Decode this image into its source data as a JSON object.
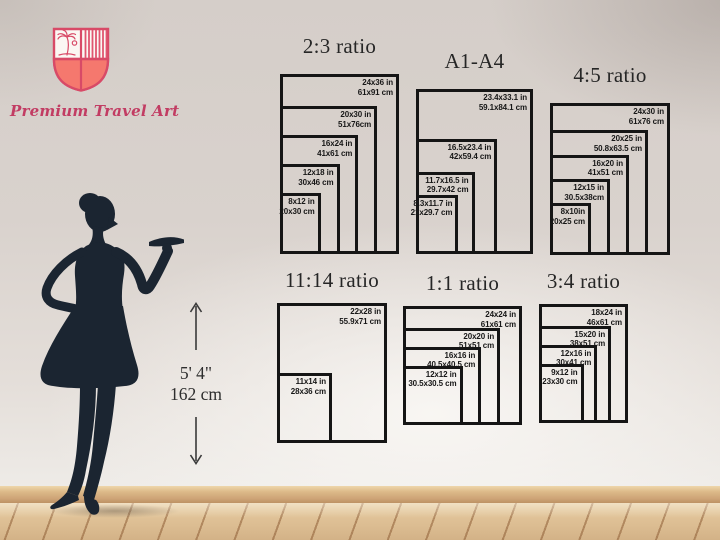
{
  "brand": {
    "name": "Premium Travel Art",
    "logo_icon": "shield-palm-crest-icon",
    "accent_color": "#d84a67",
    "shield_fill_color": "#f5786e",
    "name_color": "#c23c63"
  },
  "figure": {
    "kind": "woman-silhouette",
    "color": "#1b2531",
    "height_imperial": "5' 4\"",
    "height_metric": "162 cm"
  },
  "frame_line_color": "#151515",
  "charts": [
    {
      "title": "2:3 ratio",
      "sizes": [
        {
          "in": "24x36 in",
          "cm": "61x91 cm",
          "w": 24,
          "h": 36
        },
        {
          "in": "20x30 in",
          "cm": "51x76cm",
          "w": 20,
          "h": 30
        },
        {
          "in": "16x24 in",
          "cm": "41x61 cm",
          "w": 16,
          "h": 24
        },
        {
          "in": "12x18 in",
          "cm": "30x46 cm",
          "w": 12,
          "h": 18
        },
        {
          "in": "8x12 in",
          "cm": "20x30 cm",
          "w": 8,
          "h": 12
        }
      ]
    },
    {
      "title": "A1-A4",
      "sizes": [
        {
          "in": "23.4x33.1 in",
          "cm": "59.1x84.1 cm",
          "w": 23.4,
          "h": 33.1
        },
        {
          "in": "16.5x23.4 in",
          "cm": "42x59.4 cm",
          "w": 16.5,
          "h": 23.4
        },
        {
          "in": "11.7x16.5 in",
          "cm": "29.7x42 cm",
          "w": 11.7,
          "h": 16.5
        },
        {
          "in": "8.3x11.7 in",
          "cm": "21x29.7 cm",
          "w": 8.3,
          "h": 11.7
        }
      ]
    },
    {
      "title": "4:5 ratio",
      "sizes": [
        {
          "in": "24x30 in",
          "cm": "61x76 cm",
          "w": 24,
          "h": 30
        },
        {
          "in": "20x25 in",
          "cm": "50.8x63.5 cm",
          "w": 20,
          "h": 25
        },
        {
          "in": "16x20 in",
          "cm": "41x51 cm",
          "w": 16,
          "h": 20
        },
        {
          "in": "12x15 in",
          "cm": "30.5x38cm",
          "w": 12,
          "h": 15
        },
        {
          "in": "8x10in",
          "cm": "20x25 cm",
          "w": 8,
          "h": 10
        }
      ]
    },
    {
      "title": "11:14 ratio",
      "sizes": [
        {
          "in": "22x28 in",
          "cm": "55.9x71 cm",
          "w": 22,
          "h": 28
        },
        {
          "in": "11x14 in",
          "cm": "28x36 cm",
          "w": 11,
          "h": 14
        }
      ]
    },
    {
      "title": "1:1 ratio",
      "sizes": [
        {
          "in": "24x24 in",
          "cm": "61x61 cm",
          "w": 24,
          "h": 24
        },
        {
          "in": "20x20 in",
          "cm": "51x51 cm",
          "w": 20,
          "h": 20
        },
        {
          "in": "16x16 in",
          "cm": "40.5x40.5 cm",
          "w": 16,
          "h": 16
        },
        {
          "in": "12x12 in",
          "cm": "30.5x30.5 cm",
          "w": 12,
          "h": 12
        }
      ]
    },
    {
      "title": "3:4 ratio",
      "sizes": [
        {
          "in": "18x24 in",
          "cm": "46x61 cm",
          "w": 18,
          "h": 24
        },
        {
          "in": "15x20 in",
          "cm": "38x51 cm",
          "w": 15,
          "h": 20
        },
        {
          "in": "12x16 in",
          "cm": "30x41 cm",
          "w": 12,
          "h": 16
        },
        {
          "in": "9x12 in",
          "cm": "23x30 cm",
          "w": 9,
          "h": 12
        }
      ]
    }
  ]
}
